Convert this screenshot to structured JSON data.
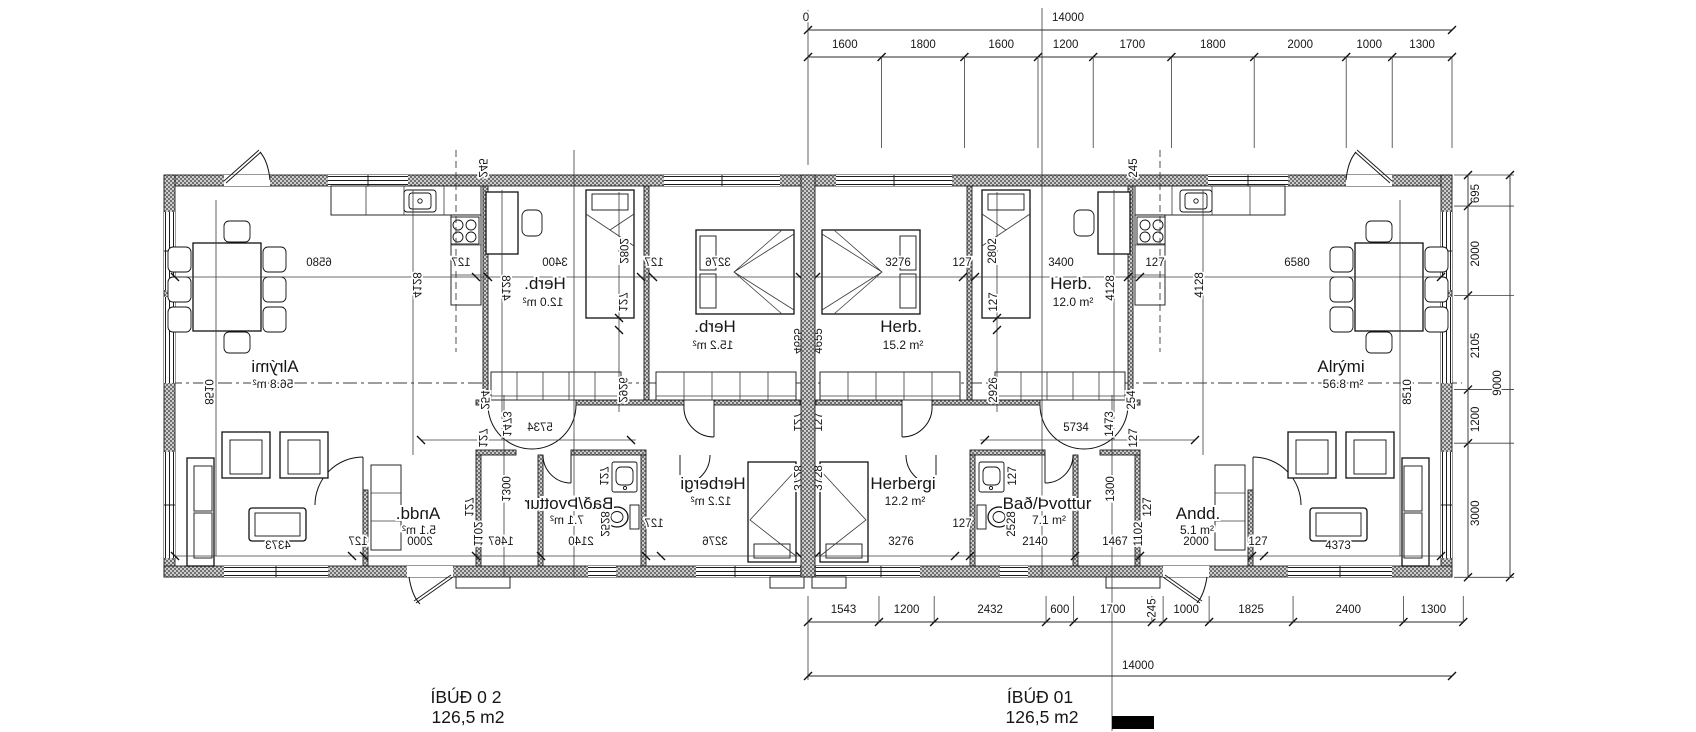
{
  "drawing": {
    "units": {
      "left": {
        "name": "ÍBÚÐ 0 2",
        "area": "126,5 m2"
      },
      "right": {
        "name": "ÍBÚÐ 01",
        "area": "126,5 m2"
      }
    },
    "chains": {
      "top": {
        "origin": "0",
        "overall": "14000",
        "segments": [
          1600,
          1800,
          1600,
          1200,
          1700,
          1800,
          2000,
          1000,
          1300
        ]
      },
      "bottom": {
        "overall": "14000",
        "segments": [
          1543,
          1200,
          2432,
          600,
          1700,
          245,
          1000,
          1825,
          2400,
          1300
        ]
      },
      "right": {
        "overall": "9000",
        "segments": [
          695,
          2000,
          2105,
          1200,
          3000
        ]
      }
    },
    "rooms": [
      {
        "name": "Herb.",
        "area": "15.2 m²"
      },
      {
        "name": "Herb.",
        "area": "12.0 m²"
      },
      {
        "name": "Alrými",
        "area": "56.8 m²"
      },
      {
        "name": "Herbergi",
        "area": "12.2 m²"
      },
      {
        "name": "Bað/Þvottur",
        "area": "7.1 m²"
      },
      {
        "name": "Andd.",
        "area": "5.1 m²"
      }
    ],
    "apartment_labels": [
      {
        "t": "3276",
        "x": 898,
        "y": 266
      },
      {
        "t": "127",
        "x": 962,
        "y": 266
      },
      {
        "t": "3400",
        "x": 1061,
        "y": 266
      },
      {
        "t": "127",
        "x": 1155,
        "y": 266
      },
      {
        "t": "6580",
        "x": 1297,
        "y": 266
      },
      {
        "t": "5734",
        "x": 1076,
        "y": 431
      },
      {
        "t": "3276",
        "x": 901,
        "y": 545
      },
      {
        "t": "127",
        "x": 962,
        "y": 527
      },
      {
        "t": "2140",
        "x": 1035,
        "y": 545
      },
      {
        "t": "1467",
        "x": 1115,
        "y": 545
      },
      {
        "t": "2000",
        "x": 1196,
        "y": 545
      },
      {
        "t": "127",
        "x": 1258,
        "y": 545
      },
      {
        "t": "4373",
        "x": 1338,
        "y": 549
      },
      {
        "t": "2802",
        "x": 996,
        "y": 251,
        "r": -90
      },
      {
        "t": "127",
        "x": 997,
        "y": 302,
        "r": -90
      },
      {
        "t": "2926",
        "x": 997,
        "y": 390,
        "r": -90
      },
      {
        "t": "4128",
        "x": 1114,
        "y": 288,
        "r": -90
      },
      {
        "t": "4128",
        "x": 1203,
        "y": 285,
        "r": -90
      },
      {
        "t": "245",
        "x": 1137,
        "y": 168,
        "r": -90
      },
      {
        "t": "254",
        "x": 1135,
        "y": 400,
        "r": -90
      },
      {
        "t": "1473",
        "x": 1113,
        "y": 424,
        "r": -90
      },
      {
        "t": "127",
        "x": 1137,
        "y": 438,
        "r": -90
      },
      {
        "t": "4655",
        "x": 822,
        "y": 341,
        "r": -90
      },
      {
        "t": "127",
        "x": 822,
        "y": 422,
        "r": -90
      },
      {
        "t": "3728",
        "x": 822,
        "y": 478,
        "r": -90
      },
      {
        "t": "8510",
        "x": 1411,
        "y": 392,
        "r": -90
      },
      {
        "t": "127",
        "x": 1016,
        "y": 476,
        "r": -90
      },
      {
        "t": "2528",
        "x": 1015,
        "y": 524,
        "r": -90
      },
      {
        "t": "1300",
        "x": 1114,
        "y": 489,
        "r": -90
      },
      {
        "t": "127",
        "x": 1151,
        "y": 507,
        "r": -90
      },
      {
        "t": "1102",
        "x": 1142,
        "y": 534,
        "r": -90
      },
      {
        "t": "Herb.",
        "x": 901,
        "y": 332,
        "cls": "room"
      },
      {
        "t": "15.2 m²",
        "x": 903,
        "y": 349,
        "cls": "area"
      },
      {
        "t": "Herb.",
        "x": 1071,
        "y": 289,
        "cls": "room"
      },
      {
        "t": "12.0 m²",
        "x": 1073,
        "y": 306,
        "cls": "area"
      },
      {
        "t": "Alrými",
        "x": 1341,
        "y": 372,
        "cls": "room"
      },
      {
        "t": "56.8 m²",
        "x": 1343,
        "y": 388,
        "cls": "area"
      },
      {
        "t": "Herbergi",
        "x": 903,
        "y": 489,
        "cls": "room"
      },
      {
        "t": "12.2 m²",
        "x": 905,
        "y": 505,
        "cls": "area"
      },
      {
        "t": "Bað/Þvottur",
        "x": 1047,
        "y": 509,
        "cls": "room"
      },
      {
        "t": "7.1 m²",
        "x": 1049,
        "y": 524,
        "cls": "area"
      },
      {
        "t": "Andd.",
        "x": 1198,
        "y": 519,
        "cls": "room"
      },
      {
        "t": "5.1 m²",
        "x": 1197,
        "y": 534,
        "cls": "area"
      }
    ]
  }
}
